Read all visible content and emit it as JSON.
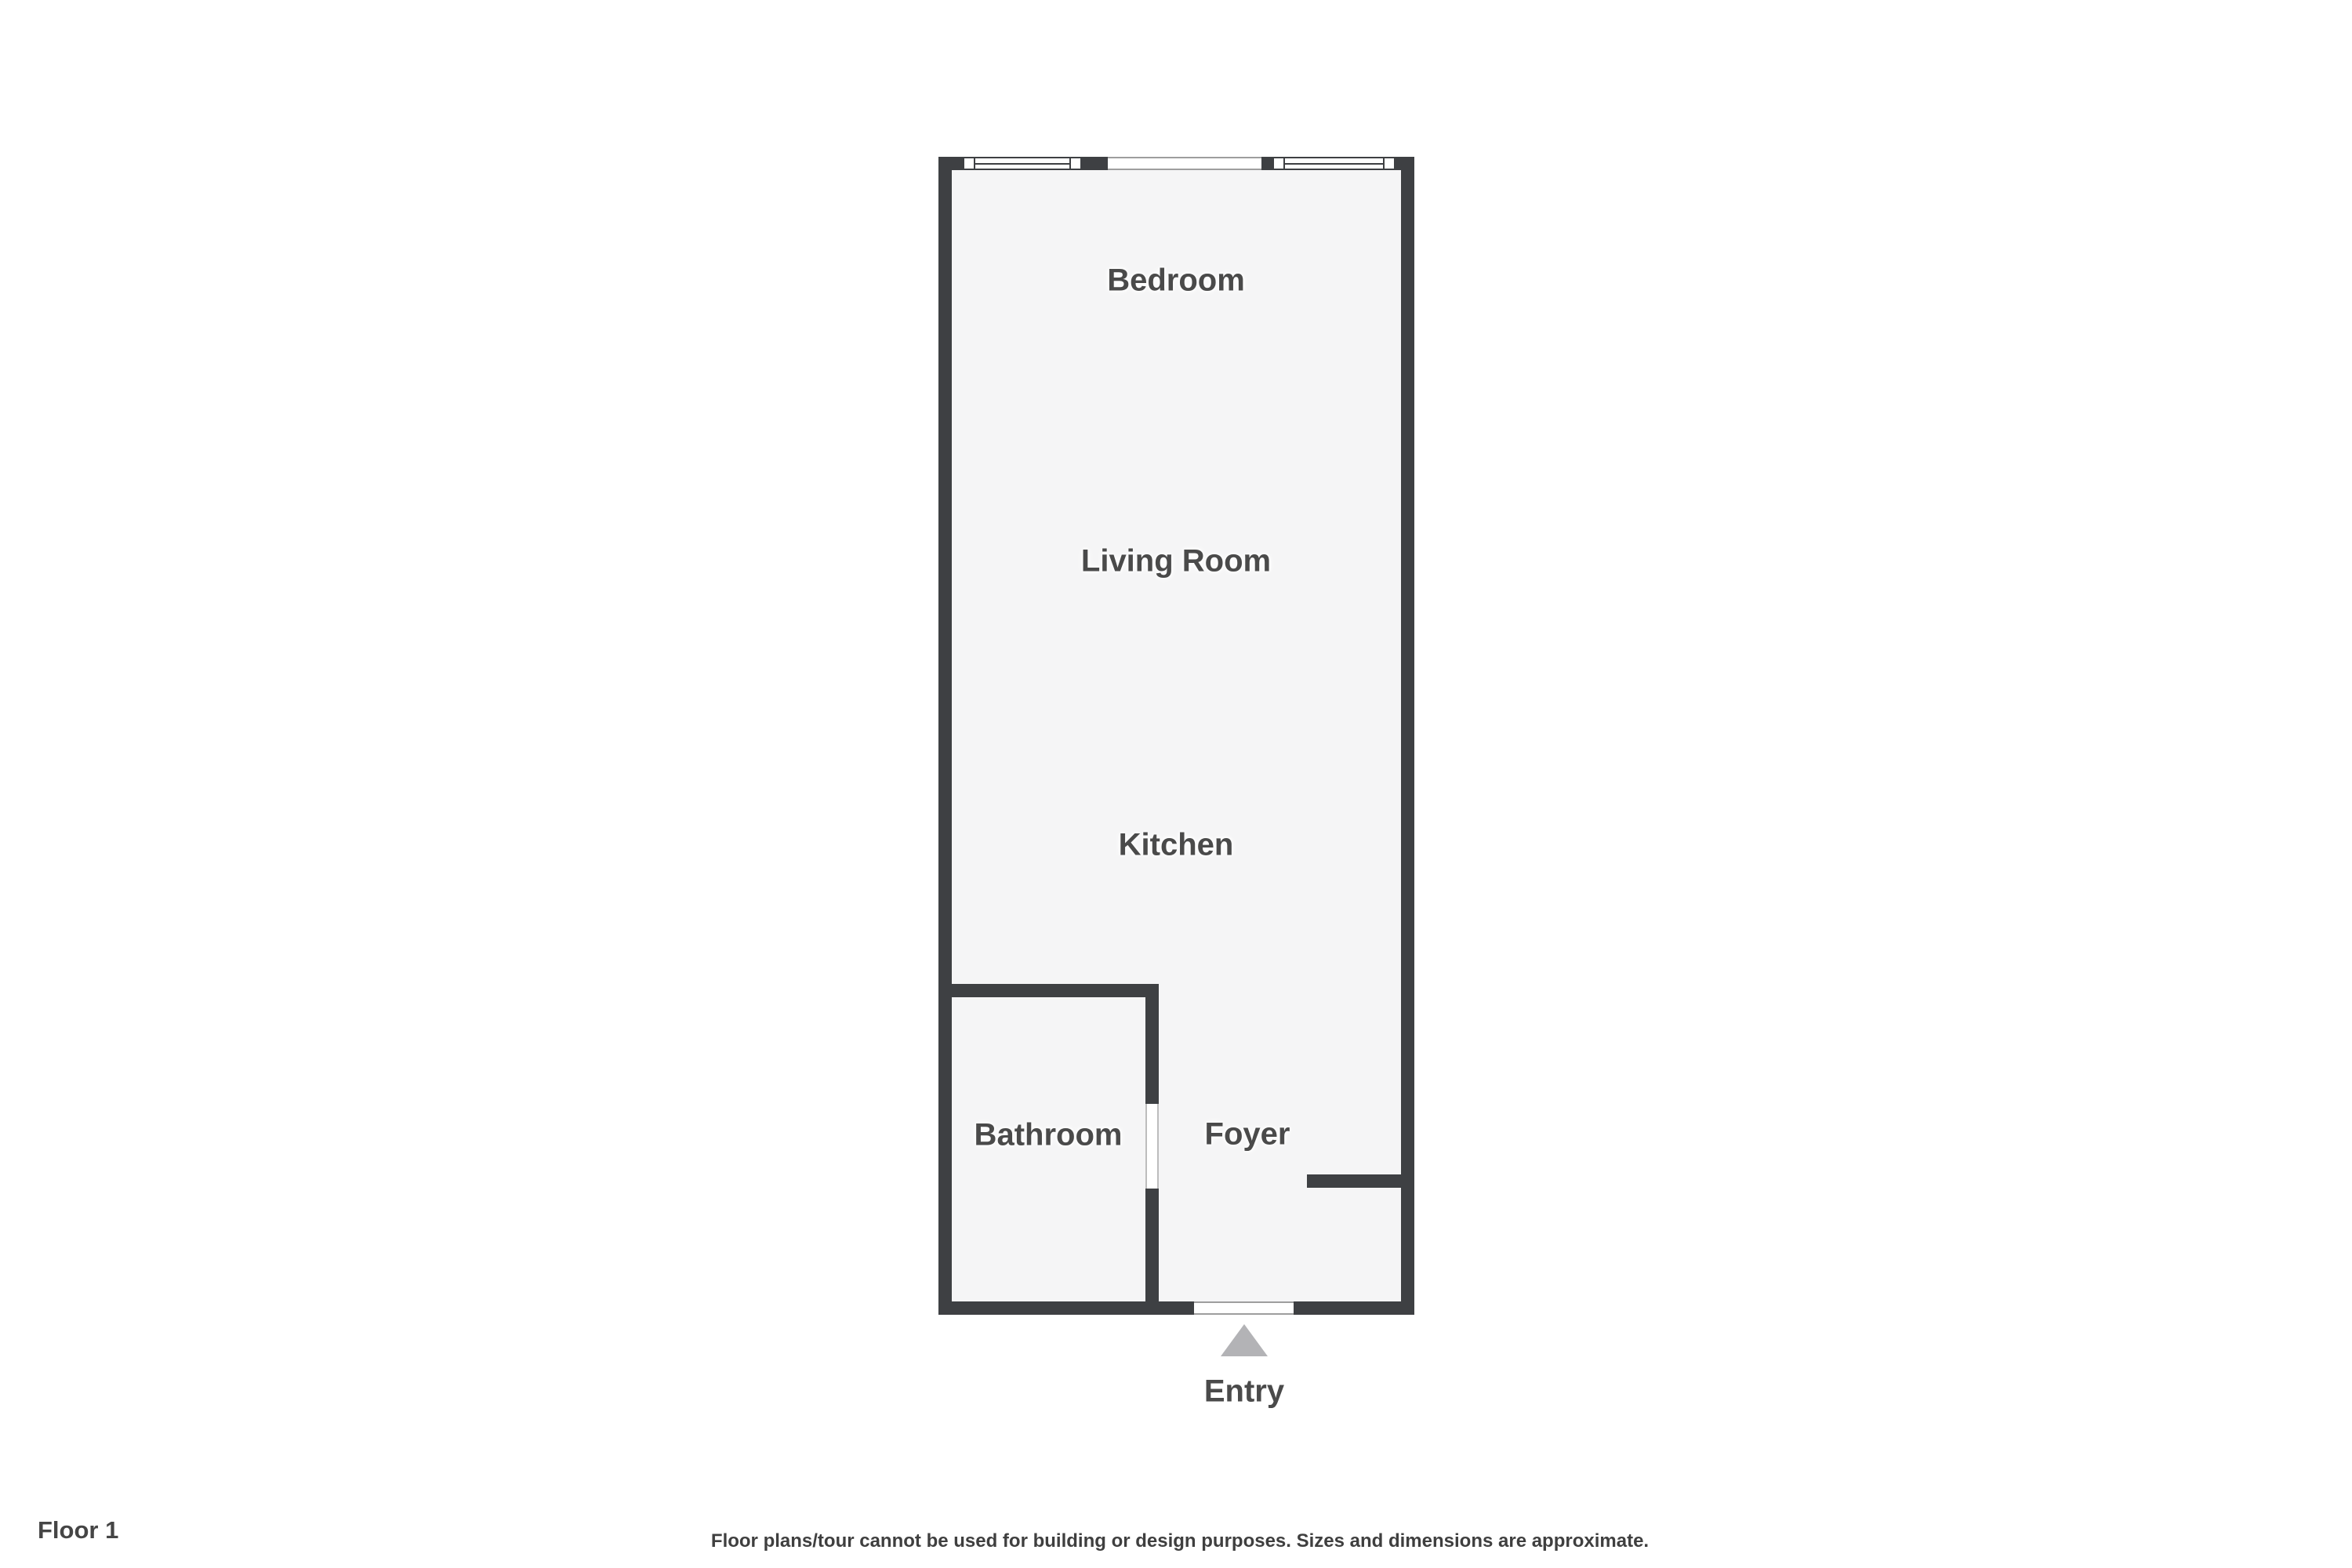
{
  "floorplan": {
    "rooms": {
      "bedroom": {
        "label": "Bedroom"
      },
      "living_room": {
        "label": "Living Room"
      },
      "kitchen": {
        "label": "Kitchen"
      },
      "bathroom": {
        "label": "Bathroom"
      },
      "foyer": {
        "label": "Foyer"
      }
    },
    "entry": {
      "label": "Entry"
    }
  },
  "footer": {
    "floor_label": "Floor 1",
    "disclaimer": "Floor plans/tour cannot be used for building or design purposes. Sizes and dimensions are approximate."
  },
  "colors": {
    "wall": "#3e4043",
    "room_fill": "#f5f5f6",
    "label_text": "#4a4a4a",
    "entry_arrow": "#b3b3b6",
    "opening_line": "#9e9e9e",
    "background": "#ffffff"
  }
}
